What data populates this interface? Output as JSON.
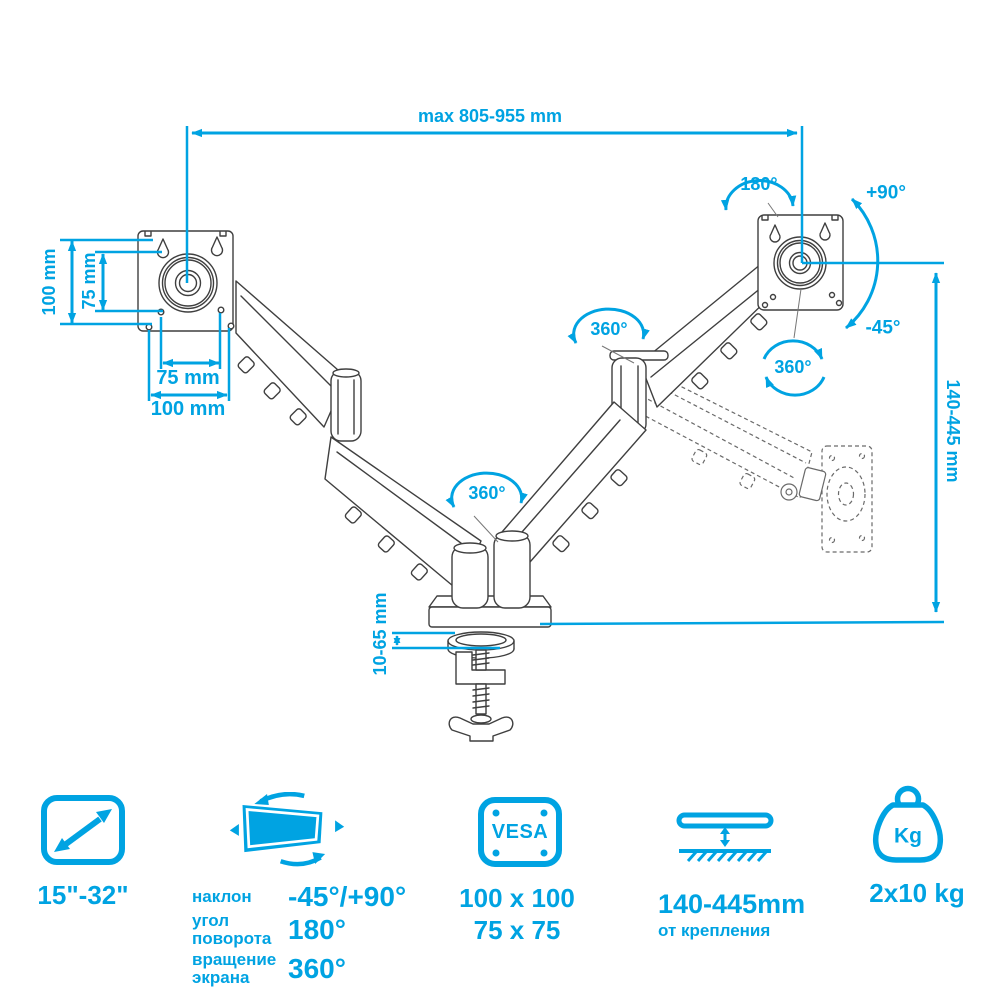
{
  "colors": {
    "accent": "#00a3e2",
    "line": "#3f3f3f"
  },
  "diagram": {
    "width_dim": "max 805-955 mm",
    "vesa_vertical_100": "100 mm",
    "vesa_vertical_75": "75 mm",
    "vesa_horizontal_75": "75 mm",
    "vesa_horizontal_100": "100 mm",
    "height_dim": "140-445 mm",
    "clamp_dim": "10-65 mm",
    "swivel_angle": "180°",
    "tilt_up_angle": "+90°",
    "tilt_down_angle": "-45°",
    "plate_rotation": "360°",
    "elbow_rotation": "360°",
    "base_rotation": "360°"
  },
  "features": {
    "screen_size": {
      "value": "15\"-32\""
    },
    "adjustability": {
      "rows": [
        {
          "label": "наклон",
          "value": "-45°/+90°"
        },
        {
          "label": "угол поворота",
          "value": "180°"
        },
        {
          "label": "вращение экрана",
          "value": "360°"
        }
      ]
    },
    "vesa": {
      "icon_text": "VESA",
      "sizes": [
        "100 x 100",
        "75 x 75"
      ]
    },
    "mount_height": {
      "value": "140-445mm",
      "caption": "от крепления"
    },
    "load": {
      "icon_text": "Kg",
      "value": "2x10 kg"
    }
  }
}
